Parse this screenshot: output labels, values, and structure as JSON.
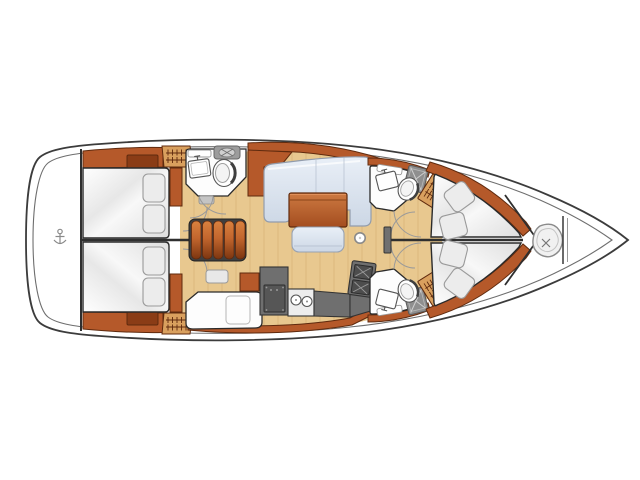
{
  "title": "Sailboat interior layout plan, top view, bow right and stern left",
  "orientation": {
    "bow": "right",
    "stern": "left"
  },
  "colors": {
    "hull-line": "#3c3c3c",
    "wood": "#b5592a",
    "wood-dark": "#5f2a0e",
    "wood-hatch": "#8a3c16",
    "louver": "#d9a05e",
    "floor": "#e8c88f",
    "floor-grain": "#d9b578",
    "cushion": "#ececec",
    "fixture-white": "#fdfdfd",
    "counter-dark": "#6f6f6f",
    "line-gray": "#9a9a9a",
    "sofa-edge": "#929cac"
  },
  "areas": [
    {
      "name": "stern-locker",
      "icon": "anchor-icon"
    },
    {
      "name": "aft-cabin-port",
      "furniture": [
        "double-berth",
        "pillow",
        "pillow",
        "hull-hatch",
        "louvered-locker",
        "wardrobe"
      ]
    },
    {
      "name": "aft-cabin-starboard",
      "furniture": [
        "double-berth",
        "pillow",
        "pillow",
        "hull-hatch",
        "louvered-locker",
        "wardrobe"
      ]
    },
    {
      "name": "companionway-steps",
      "furniture": [
        "five-tread-stair"
      ]
    },
    {
      "name": "amidships-head",
      "furniture": [
        "washbasin",
        "toilet",
        "shelf",
        "vanity-unit"
      ]
    },
    {
      "name": "galley",
      "furniture": [
        "white-counter",
        "oven-unit",
        "double-sink",
        "worktop",
        "two-burner-stove",
        "hull-trim"
      ]
    },
    {
      "name": "salon",
      "furniture": [
        "l-shaped-sofa",
        "folding-table",
        "bench-seat",
        "mast-post"
      ]
    },
    {
      "name": "forward-cabin-port",
      "furniture": [
        "head-washbasin",
        "head-toilet",
        "shower-hatch",
        "louvered-steps",
        "v-berth",
        "cushion",
        "cushion"
      ]
    },
    {
      "name": "forward-cabin-starboard",
      "furniture": [
        "head-washbasin",
        "head-toilet",
        "shower-hatch",
        "louvered-steps",
        "v-berth",
        "cushion",
        "cushion"
      ]
    },
    {
      "name": "bow-sail-locker",
      "icon": "rope-coil-icon"
    }
  ]
}
